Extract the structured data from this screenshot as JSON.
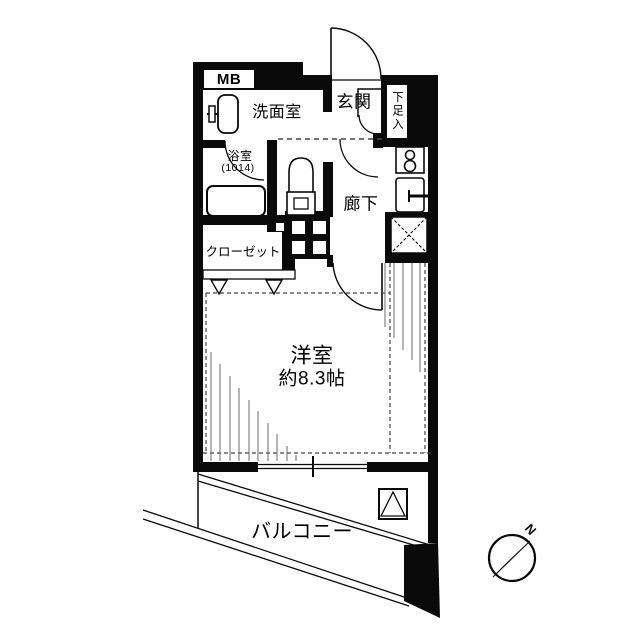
{
  "floorplan": {
    "rooms": {
      "meter_box": {
        "label": "MB"
      },
      "washroom": {
        "label": "洗面室"
      },
      "bathroom": {
        "label": "浴室",
        "size": "(1014)"
      },
      "entrance": {
        "label": "玄関"
      },
      "shoe_cabinet": {
        "label": "下足入"
      },
      "hallway": {
        "label": "廊下"
      },
      "closet": {
        "label": "クローゼット"
      },
      "western_room": {
        "label": "洋室",
        "size": "約8.3帖"
      },
      "balcony": {
        "label": "バルコニー"
      }
    },
    "compass": {
      "north_label": "N"
    },
    "colors": {
      "wall": "#0a0a0a",
      "background": "#ffffff",
      "hatch_line": "#6b6b6b",
      "dashed_line": "#444444"
    }
  }
}
